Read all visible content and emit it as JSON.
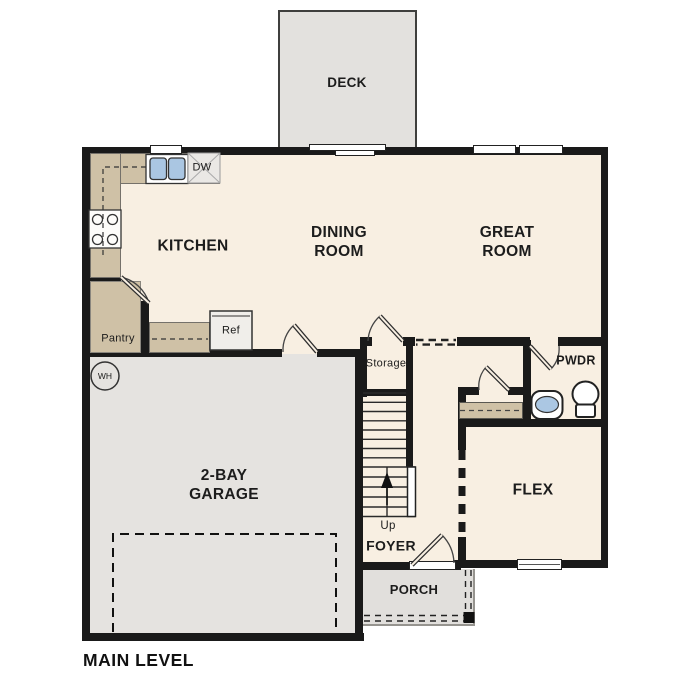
{
  "plan": {
    "title": "MAIN LEVEL",
    "rooms": [
      {
        "id": "deck",
        "label": "DECK"
      },
      {
        "id": "kitchen",
        "label": "KITCHEN"
      },
      {
        "id": "dining",
        "label": "DINING ROOM"
      },
      {
        "id": "great",
        "label": "GREAT ROOM"
      },
      {
        "id": "garage",
        "label": "2-BAY GARAGE"
      },
      {
        "id": "flex",
        "label": "FLEX"
      },
      {
        "id": "foyer",
        "label": "FOYER"
      },
      {
        "id": "porch",
        "label": "PORCH"
      },
      {
        "id": "powder",
        "label": "PWDR"
      },
      {
        "id": "storage",
        "label": "Storage"
      },
      {
        "id": "pantry",
        "label": "Pantry"
      }
    ],
    "fixtures": [
      {
        "id": "dishwasher",
        "label": "DW"
      },
      {
        "id": "refrigerator",
        "label": "Ref"
      },
      {
        "id": "water-heater",
        "label": "WH"
      },
      {
        "id": "stairs-up",
        "label": "Up"
      }
    ],
    "unlabeled_fixtures": [
      "kitchen-sink",
      "cooktop",
      "coat-closet",
      "powder-sink",
      "toilet",
      "deck-sliding-door",
      "front-door",
      "garage-entry-door",
      "pantry-door",
      "storage-door",
      "powder-door",
      "closet-door",
      "garage-door-outline",
      "porch-post",
      "windows"
    ],
    "colors": {
      "wall": "#1a1a1a",
      "floor": "#f8efe2",
      "counter_tan": "#cfc1a6",
      "deck_gray": "#e3e1de",
      "garage_gray": "#e5e3e0",
      "porch_gray": "#e1dfdc",
      "fixture_blue": "#aac6e2"
    }
  }
}
